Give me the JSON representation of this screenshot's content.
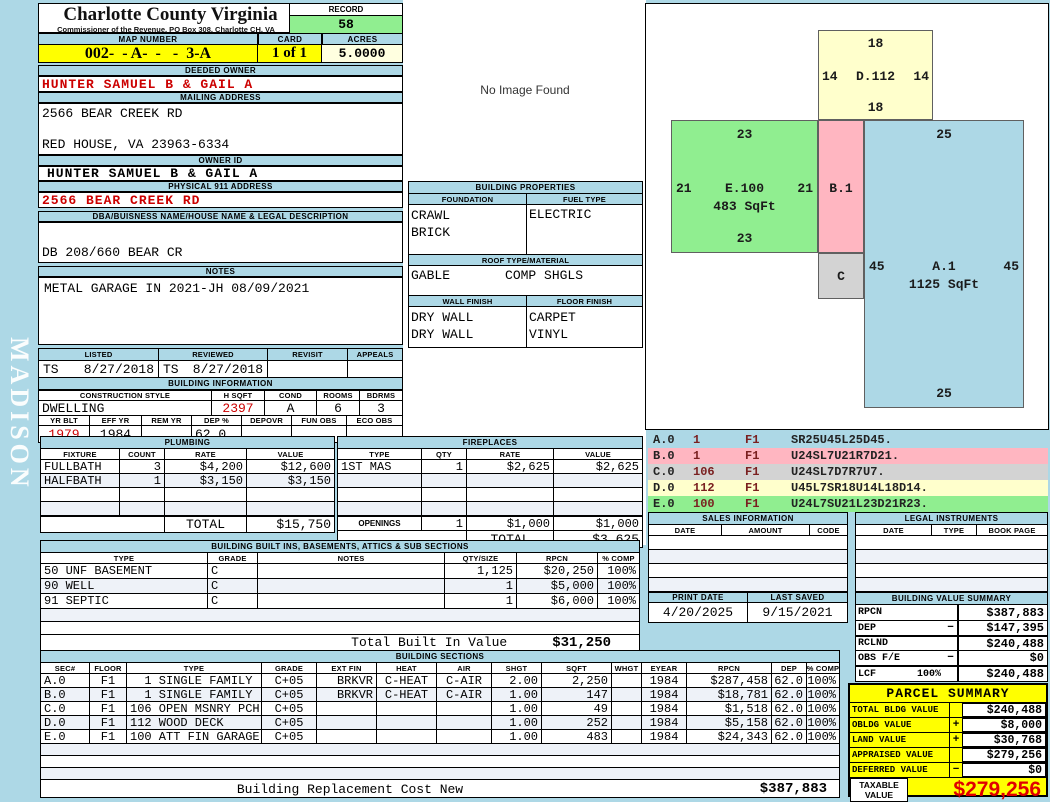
{
  "colors": {
    "page_blue": "#ADD8E6",
    "record_green": "#90EE90",
    "map_yellow": "#FFFF00",
    "acres_ivory": "#FFFFE0",
    "sketch_yellow": "#FFFFCC",
    "sketch_pink": "#FFB6C1",
    "sketch_gray": "#D3D3D3",
    "value_red": "#CC0000",
    "taxable_red": "#E00000"
  },
  "meta": {
    "title": "Charlotte County Virginia",
    "subtitle": "Commissioner of the Revenue, PO  Box 308, Charlotte CH, VA",
    "sidebar_text": "MADISON",
    "no_image_text": "No Image Found"
  },
  "record": {
    "label": "RECORD",
    "value": "58"
  },
  "map_row": {
    "map_label": "MAP NUMBER",
    "map_value": "002-  - A-  -   -  3-A",
    "card_label": "CARD",
    "card_value": "1 of 1",
    "acres_label": "ACRES",
    "acres_value": "5.0000"
  },
  "owner": {
    "deeded_label": "DEEDED OWNER",
    "deeded_value": "HUNTER SAMUEL B & GAIL A",
    "mailing_label": "MAILING ADDRESS",
    "mailing_line1": "2566 BEAR CREEK RD",
    "mailing_line2": "RED HOUSE, VA 23963-6334",
    "owner_id_label": "OWNER ID",
    "owner_id_value": "HUNTER SAMUEL B & GAIL A",
    "physical_label": "PHYSICAL 911 ADDRESS",
    "physical_value": "2566 BEAR CREEK  RD",
    "dba_label": "DBA/BUISNESS NAME/HOUSE NAME & LEGAL DESCRIPTION",
    "dba_value": "DB 208/660 BEAR CR",
    "notes_label": "NOTES",
    "notes_value": "METAL GARAGE IN 2021-JH 08/09/2021"
  },
  "review": {
    "listed_label": "LISTED",
    "reviewed_label": "REVIEWED",
    "revisit_label": "REVISIT",
    "appeals_label": "APPEALS",
    "listed_by": "TS",
    "listed_date": "8/27/2018",
    "reviewed_by": "TS",
    "reviewed_date": "8/27/2018",
    "revisit_value": "",
    "appeals_value": ""
  },
  "building_info": {
    "title": "BUILDING INFORMATION",
    "style_label": "CONSTRUCTION STYLE",
    "hsqft_label": "H SQFT",
    "cond_label": "COND",
    "rooms_label": "ROOMS",
    "bdrms_label": "BDRMS",
    "style_value": "DWELLING",
    "hsqft_value": "2397",
    "cond_value": "A",
    "rooms_value": "6",
    "bdrms_value": "3",
    "yrblt_label": "YR BLT",
    "effyr_label": "EFF YR",
    "remyr_label": "REM YR",
    "dep_label": "DEP %",
    "depovr_label": "DEPOVR",
    "funobs_label": "FUN OBS",
    "ecoobs_label": "ECO OBS",
    "yrblt_value": "1979",
    "effyr_value": "1984",
    "remyr_value": "",
    "dep_value": "62.0",
    "depovr_value": "",
    "funobs_value": "",
    "ecoobs_value": ""
  },
  "building_properties": {
    "title": "BUILDING PROPERTIES",
    "foundation_label": "FOUNDATION",
    "fuel_label": "FUEL TYPE",
    "foundation_line1": "CRAWL",
    "foundation_line2": "BRICK",
    "fuel_line1": "ELECTRIC",
    "roof_label": "ROOF TYPE/MATERIAL",
    "roof_type": "GABLE",
    "roof_material": "COMP SHGLS",
    "wall_label": "WALL FINISH",
    "floor_label": "FLOOR FINISH",
    "wall_line1": "DRY WALL",
    "wall_line2": "DRY WALL",
    "floor_line1": "CARPET",
    "floor_line2": "VINYL"
  },
  "plumbing": {
    "title": "PLUMBING",
    "headers": [
      "FIXTURE",
      "COUNT",
      "RATE",
      "VALUE"
    ],
    "rows": [
      [
        "FULLBATH",
        "3",
        "$4,200",
        "$12,600"
      ],
      [
        "HALFBATH",
        "1",
        "$3,150",
        "$3,150"
      ]
    ],
    "total_label": "TOTAL",
    "total_value": "$15,750"
  },
  "fireplaces": {
    "title": "FIREPLACES",
    "headers": [
      "TYPE",
      "QTY",
      "RATE",
      "VALUE"
    ],
    "rows": [
      [
        "1ST MAS",
        "1",
        "$2,625",
        "$2,625"
      ]
    ],
    "openings_label": "OPENINGS",
    "openings_qty": "1",
    "openings_rate": "$1,000",
    "openings_value": "$1,000",
    "total_label": "TOTAL",
    "total_value": "$3,625"
  },
  "sketch": {
    "shapes": [
      {
        "name": "D.112",
        "top": "18",
        "left": "14",
        "right": "14",
        "bottom": "18",
        "sqft": ""
      },
      {
        "name": "E.100",
        "top": "23",
        "left": "21",
        "right": "21",
        "bottom": "23",
        "sqft": "483 SqFt"
      },
      {
        "name": "B.1"
      },
      {
        "name": "C"
      },
      {
        "name": "A.1",
        "top": "25",
        "left": "45",
        "right": "45",
        "bottom": "25",
        "sqft": "1125 SqFt"
      }
    ]
  },
  "vectors": {
    "rows": [
      {
        "code": "A.0",
        "num": "1",
        "f": "F1",
        "path": "SR25U45L25D45."
      },
      {
        "code": "B.0",
        "num": "1",
        "f": "F1",
        "path": "U24SL7U21R7D21."
      },
      {
        "code": "C.0",
        "num": "106",
        "f": "F1",
        "path": "U24SL7D7R7U7."
      },
      {
        "code": "D.0",
        "num": "112",
        "f": "F1",
        "path": "U45L7SR18U14L18D14."
      },
      {
        "code": "E.0",
        "num": "100",
        "f": "F1",
        "path": "U24L7SU21L23D21R23."
      }
    ]
  },
  "sales": {
    "title": "SALES INFORMATION",
    "headers": [
      "DATE",
      "AMOUNT",
      "CODE"
    ]
  },
  "legal": {
    "title": "LEGAL INSTRUMENTS",
    "headers": [
      "DATE",
      "TYPE",
      "BOOK PAGE"
    ]
  },
  "dates": {
    "print_label": "PRINT DATE",
    "print_value": "4/20/2025",
    "saved_label": "LAST SAVED",
    "saved_value": "9/15/2021"
  },
  "value_summary": {
    "title": "BUILDING VALUE SUMMARY",
    "rows": [
      {
        "label": "RPCN",
        "pct": "",
        "sign": "",
        "value": "$387,883"
      },
      {
        "label": "DEP",
        "pct": "",
        "sign": "−",
        "value": "$147,395"
      },
      {
        "label": "RCLND",
        "pct": "",
        "sign": "",
        "value": "$240,488"
      },
      {
        "label": "OBS F/E",
        "pct": "",
        "sign": "−",
        "value": "$0"
      },
      {
        "label": "LCF",
        "pct": "100%",
        "sign": "",
        "value": "$240,488"
      }
    ]
  },
  "built_ins": {
    "title": "BUILDING BUILT INS, BASEMENTS, ATTICS & SUB SECTIONS",
    "headers": [
      "TYPE",
      "GRADE",
      "NOTES",
      "QTY/SIZE",
      "RPCN",
      "% COMP"
    ],
    "rows": [
      [
        "50 UNF BASEMENT",
        "C",
        "",
        "1,125",
        "$20,250",
        "100%"
      ],
      [
        "90 WELL",
        "C",
        "",
        "1",
        "$5,000",
        "100%"
      ],
      [
        "91 SEPTIC",
        "C",
        "",
        "1",
        "$6,000",
        "100%"
      ]
    ],
    "total_label": "Total Built In Value",
    "total_value": "$31,250"
  },
  "sections": {
    "title": "BUILDING SECTIONS",
    "headers": [
      "SEC#",
      "FLOOR",
      "TYPE",
      "GRADE",
      "EXT FIN",
      "HEAT",
      "AIR",
      "SHGT",
      "SQFT",
      "WHGT",
      "EYEAR",
      "RPCN",
      "DEP",
      "% COMP"
    ],
    "rows": [
      [
        "A.0",
        "F1",
        "  1 SINGLE FAMILY",
        "C+05",
        "BRKVR",
        "C-HEAT",
        "C-AIR",
        "2.00",
        "2,250",
        "",
        "1984",
        "$287,458",
        "62.0",
        "100%"
      ],
      [
        "B.0",
        "F1",
        "  1 SINGLE FAMILY",
        "C+05",
        "BRKVR",
        "C-HEAT",
        "C-AIR",
        "1.00",
        "147",
        "",
        "1984",
        "$18,781",
        "62.0",
        "100%"
      ],
      [
        "C.0",
        "F1",
        "106 OPEN MSNRY PCH",
        "C+05",
        "",
        "",
        "",
        "1.00",
        "49",
        "",
        "1984",
        "$1,518",
        "62.0",
        "100%"
      ],
      [
        "D.0",
        "F1",
        "112 WOOD DECK",
        "C+05",
        "",
        "",
        "",
        "1.00",
        "252",
        "",
        "1984",
        "$5,158",
        "62.0",
        "100%"
      ],
      [
        "E.0",
        "F1",
        "100 ATT FIN GARAGE",
        "C+05",
        "",
        "",
        "",
        "1.00",
        "483",
        "",
        "1984",
        "$24,343",
        "62.0",
        "100%"
      ]
    ]
  },
  "replacement": {
    "label": "Building Replacement Cost New",
    "value": "$387,883"
  },
  "parcel": {
    "title": "PARCEL SUMMARY",
    "rows": [
      {
        "label": "TOTAL BLDG VALUE",
        "sign": "",
        "value": "$240,488"
      },
      {
        "label": "OBLDG VALUE",
        "sign": "+",
        "value": "$8,000"
      },
      {
        "label": "LAND VALUE",
        "sign": "+",
        "value": "$30,768"
      },
      {
        "label": "APPRAISED VALUE",
        "sign": "",
        "value": "$279,256"
      },
      {
        "label": "DEFERRED VALUE",
        "sign": "−",
        "value": "$0"
      }
    ],
    "taxable_label_line1": "TAXABLE",
    "taxable_label_line2": "VALUE",
    "taxable_value": "$279,256"
  }
}
